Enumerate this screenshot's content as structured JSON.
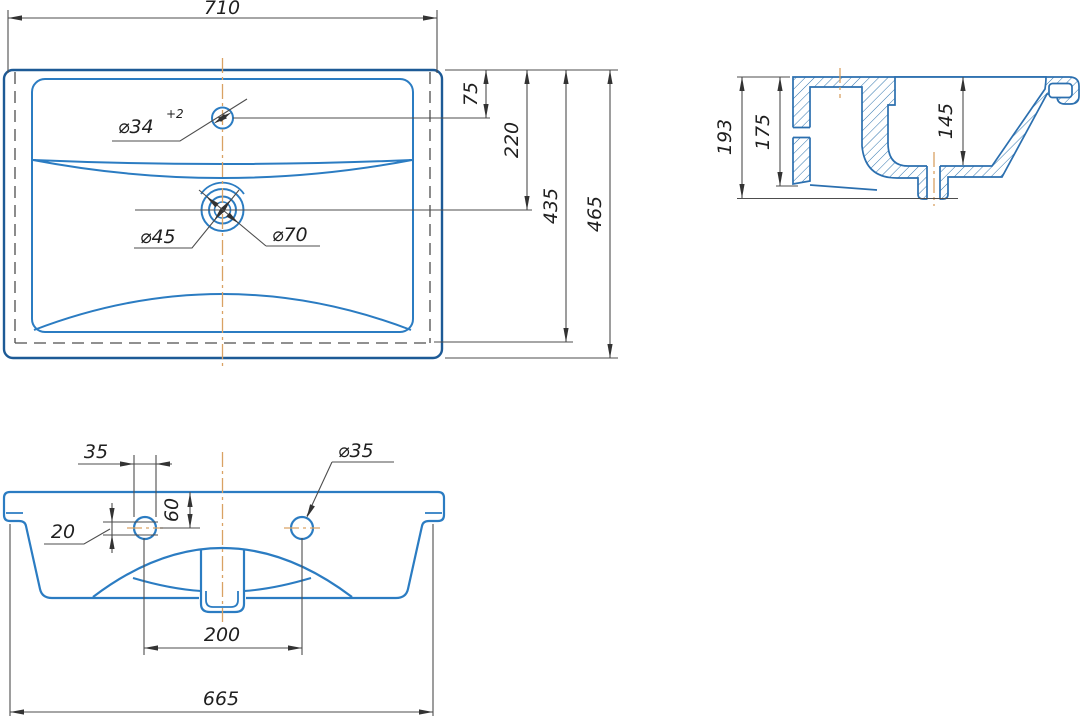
{
  "drawing_type": "washbasin technical drawing, three orthographic views",
  "colors": {
    "outline_blue": "#2b7cc2",
    "outline_blue_dark": "#1d5a96",
    "dimension_line": "#4d4d4d",
    "dimension_text": "#1f1f1f",
    "centerline_tan": "#d9a263",
    "hatch_blue": "#2f74ad",
    "background": "#ffffff"
  },
  "plan": {
    "overall_width": "710",
    "faucet_offset": "75",
    "drain_offset": "220",
    "inner_length": "435",
    "overall_depth": "465",
    "faucet_dia": "⌀34",
    "faucet_tol": "+2",
    "drain_inner": "⌀45",
    "drain_outer": "⌀70"
  },
  "section": {
    "overall_height": "193",
    "back_height": "175",
    "bowl_depth": "145"
  },
  "front": {
    "hole_width": "35",
    "top_to_hole": "60",
    "hole_vertical": "20",
    "hole_dia": "⌀35",
    "hole_spacing": "200",
    "bottom_width": "665"
  }
}
